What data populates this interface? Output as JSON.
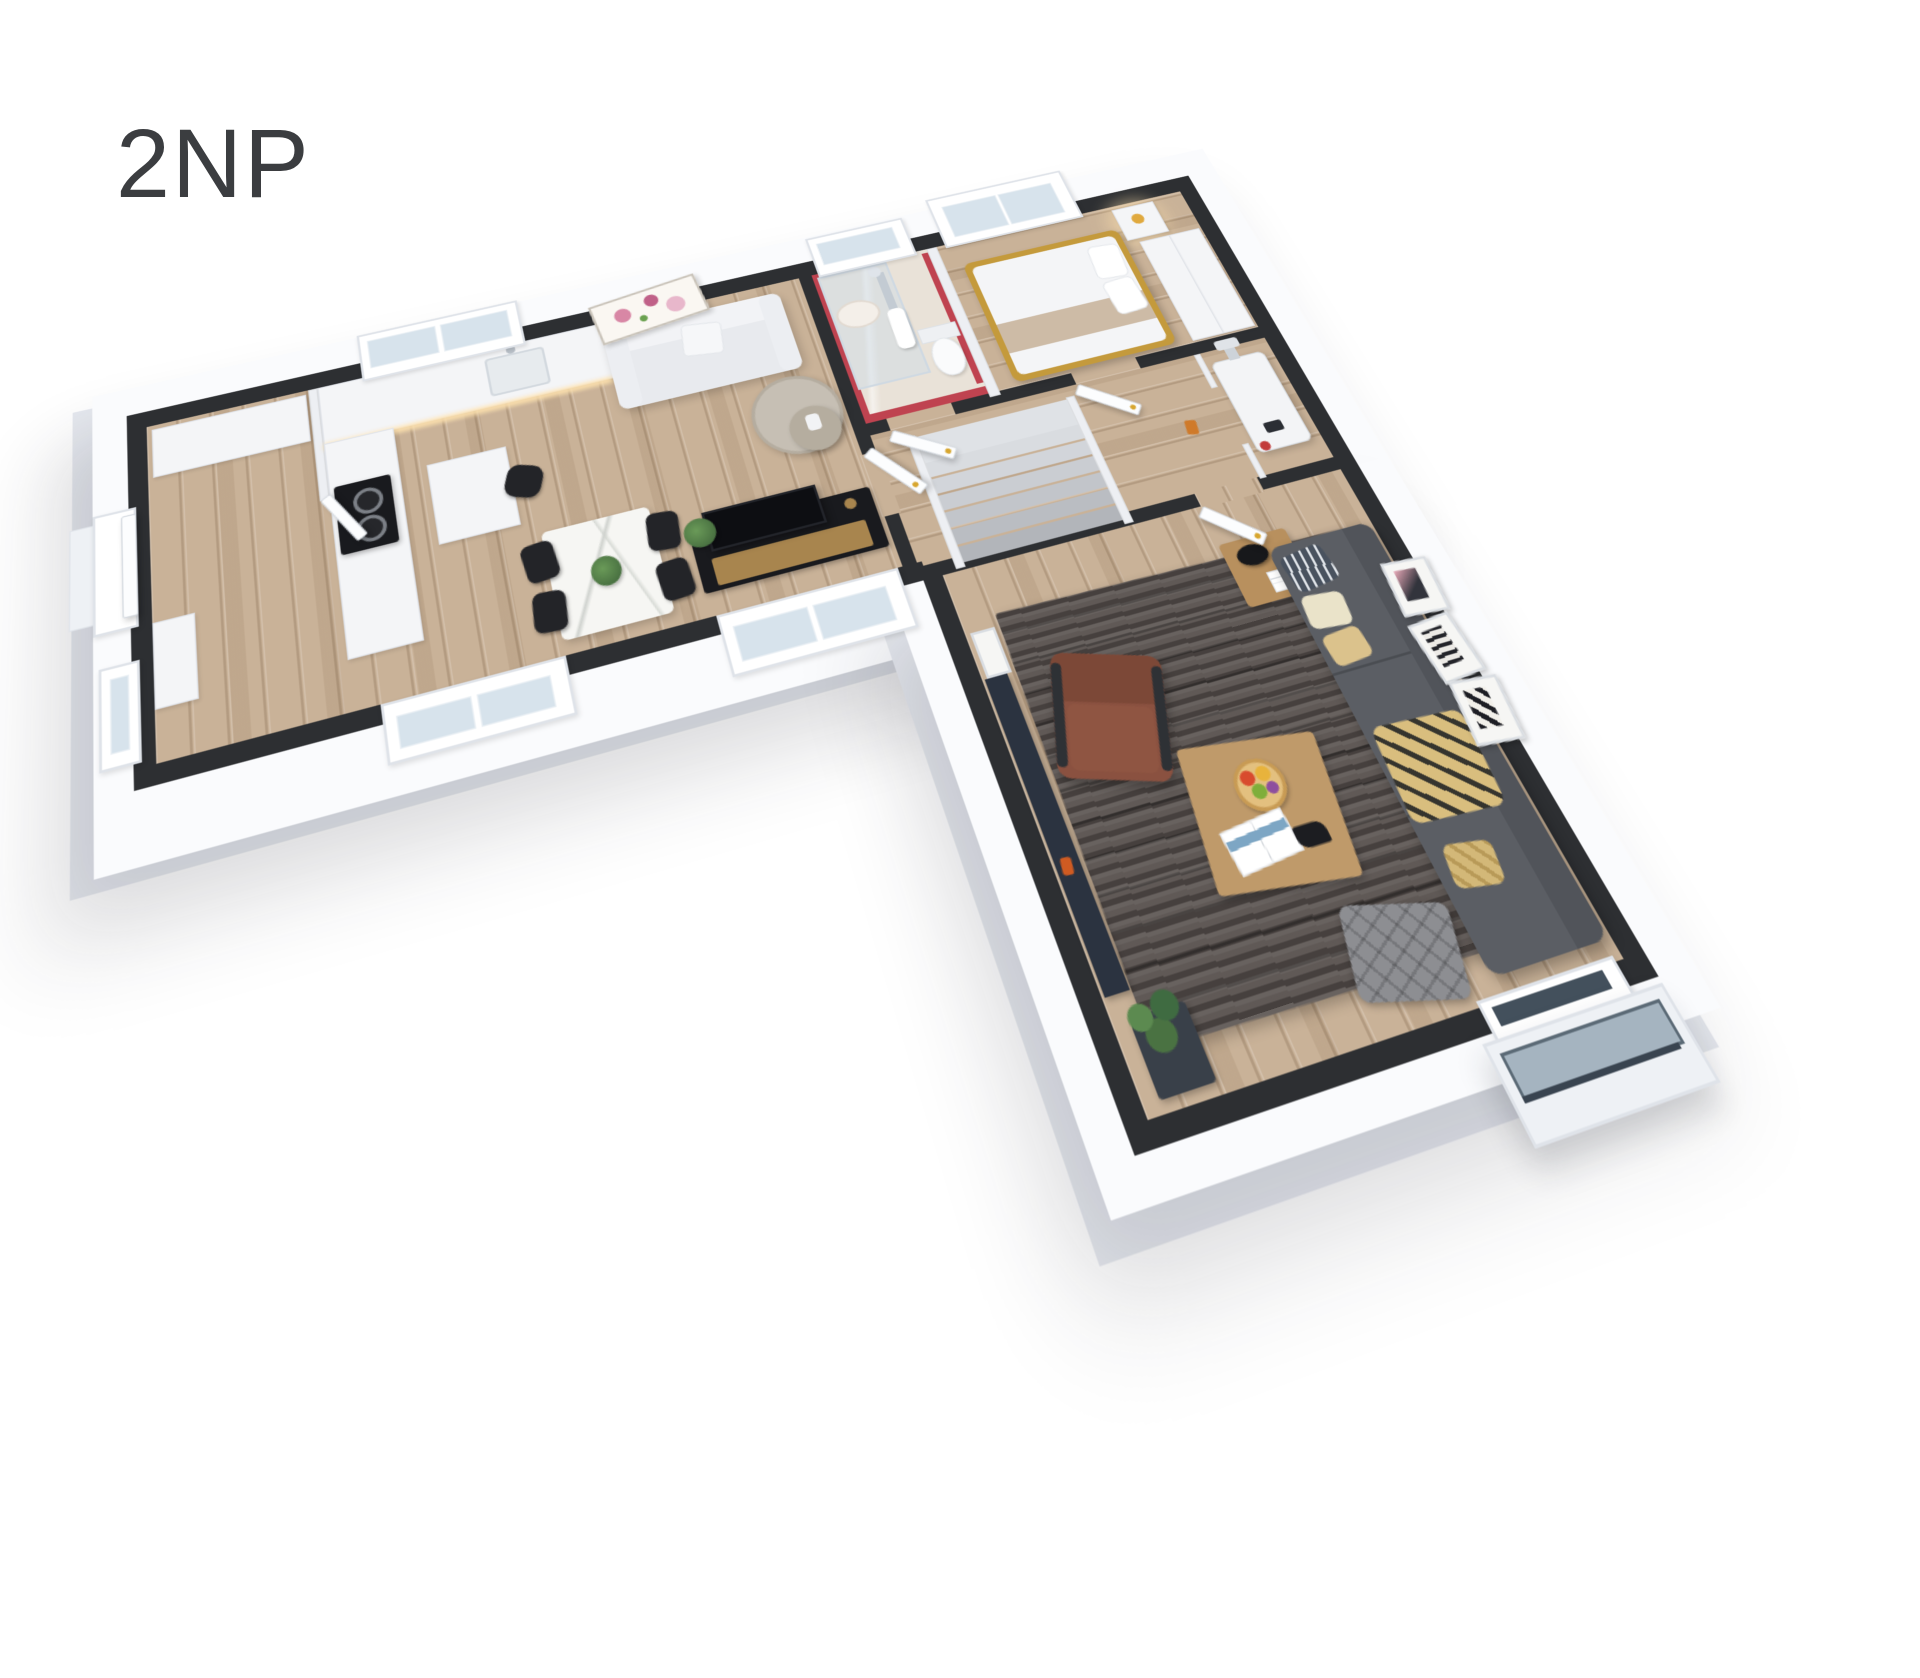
{
  "floor": {
    "label": "2NP"
  },
  "rooms": [
    {
      "id": "entry-hall",
      "features": [
        "entrance-door",
        "wardrobe",
        "console-cabinet"
      ]
    },
    {
      "id": "kitchen-dining-living",
      "features": [
        "kitchen-counter",
        "sink",
        "gas-hob",
        "island-desk",
        "office-chair",
        "marble-dining-table",
        "dining-chairs",
        "white-sofa",
        "magnolia-painting",
        "round-coffee-tables",
        "tv-sideboard",
        "tv"
      ]
    },
    {
      "id": "bathroom",
      "features": [
        "glass-shower",
        "washbasin",
        "toilet",
        "towel",
        "red-accent-walls",
        "window"
      ]
    },
    {
      "id": "bedroom",
      "features": [
        "double-bed",
        "gold-bed-frame",
        "pillows",
        "nightstand",
        "bedside-lamp-glow",
        "wardrobe",
        "window"
      ]
    },
    {
      "id": "technical-closet",
      "features": [
        "gas-boiler"
      ]
    },
    {
      "id": "hallway",
      "features": [
        "staircase",
        "white-doors",
        "gold-door-handles"
      ]
    },
    {
      "id": "living-room",
      "features": [
        "dark-gray-sofa",
        "pillows",
        "gold-throw",
        "brown-leather-armchair",
        "wooden-coffee-table",
        "fruit-bowl",
        "magazine",
        "side-table",
        "black-table-lamp",
        "area-rug",
        "tv-panel",
        "pouf",
        "potted-plant",
        "wall-art-frames"
      ]
    },
    {
      "id": "balcony",
      "features": [
        "balcony-door",
        "glass-railing"
      ]
    }
  ],
  "colors": {
    "background": "#ffffff",
    "title_color": "#3b3d40",
    "wall_top": "#2d2f32",
    "wall_partition": "#edeff3",
    "rim_white": "#fafbfd",
    "rim_shade": "#e6e9ef",
    "floor_wood": "#c9b298",
    "bathroom_floor": "#e9e2d8",
    "accent_red": "#bf4350",
    "glass": "#d7e3ec",
    "sofa_light": "#e8eaee",
    "sofa_dark": "#5b5e64",
    "armchair_brown": "#8a5140",
    "rug_base": "#57504d",
    "wood_table": "#bf9a6a",
    "marble_table": "#f6f6f3",
    "black_furniture": "#191a1e",
    "gold_accent": "#a8854e",
    "handle_gold": "#d7a62f",
    "plant_green": "#4a7242",
    "stair_light": "#dfe2e6",
    "boiler_white": "#f3f4f6",
    "glow_warm": "#ffe3b0",
    "bed_gold": "#c49a3c",
    "tv_screen": "#0d0e12",
    "balcony_glass": "#a5b4c0",
    "painting_pink": "#d887a5"
  }
}
